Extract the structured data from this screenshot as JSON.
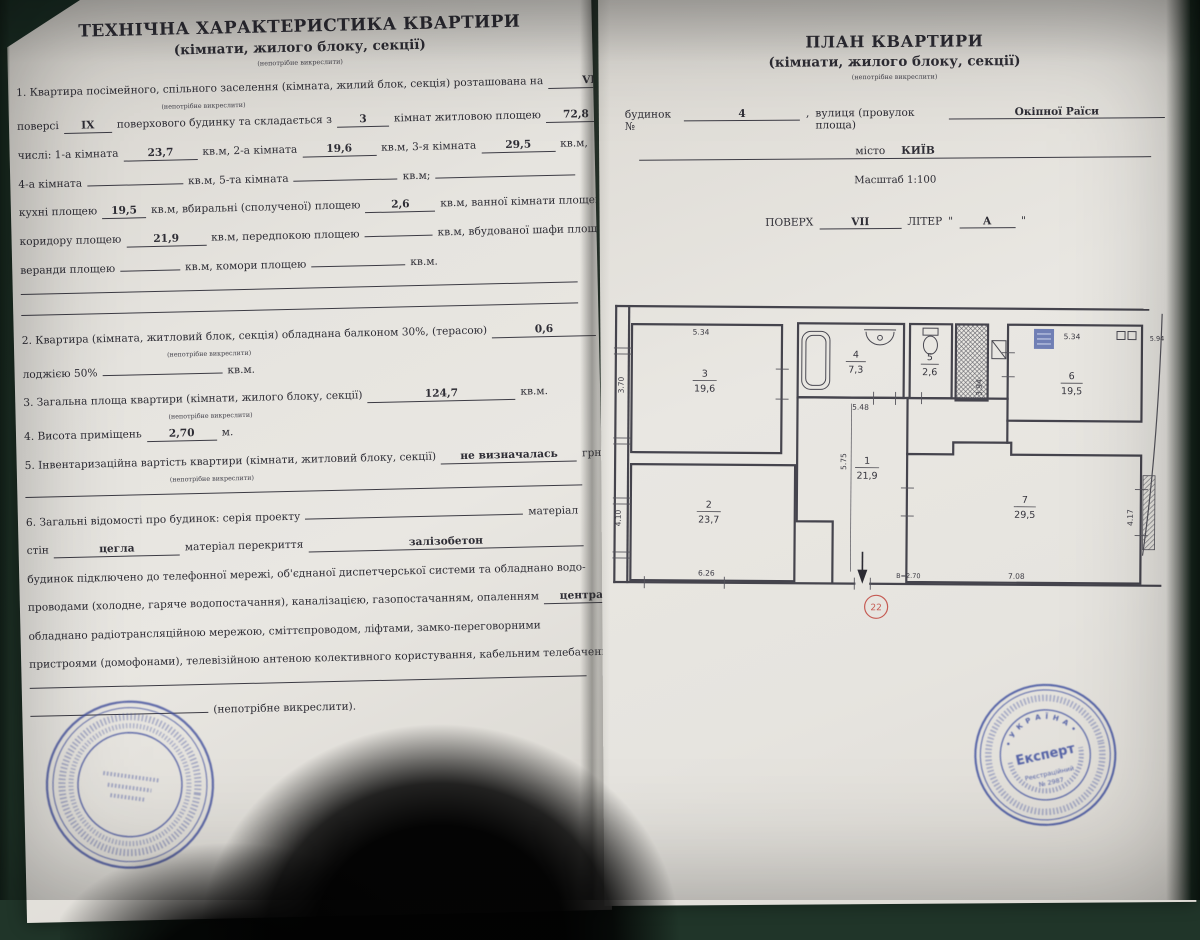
{
  "left_page": {
    "title": "ТЕХНІЧНА ХАРАКТЕРИСТИКА КВАРТИРИ",
    "subtitle": "(кімнати, жилого блоку, секції)",
    "strike_note": "(непотрібне викреслити)",
    "lines": [
      {
        "segs": [
          {
            "t": "1. Квартира посімейного, спільного заселення (кімната, жилий блок, секція) розташована на"
          },
          {
            "u": "VII",
            "w": 78,
            "fx": 1
          }
        ]
      },
      {
        "type": "note",
        "text": "(непотрібне викреслити)"
      },
      {
        "segs": [
          {
            "t": "поверсі"
          },
          {
            "u": "IX",
            "w": 40
          },
          {
            "t": "поверхового будинку та складається з"
          },
          {
            "u": "3",
            "w": 44
          },
          {
            "t": "кімнат житловою площею"
          },
          {
            "u": "72,8",
            "w": 52
          },
          {
            "t": "кв.м, у тому"
          }
        ]
      },
      {
        "segs": [
          {
            "t": "числі: 1-а кімната"
          },
          {
            "u": "23,7",
            "w": 66
          },
          {
            "t": "кв.м, 2-а кімната"
          },
          {
            "u": "19,6",
            "w": 66
          },
          {
            "t": "кв.м, 3-я кімната"
          },
          {
            "u": "29,5",
            "w": 66
          },
          {
            "t": "кв.м,"
          }
        ]
      },
      {
        "segs": [
          {
            "t": "4-а кімната"
          },
          {
            "u": "",
            "w": 88
          },
          {
            "t": "кв.м, 5-та кімната"
          },
          {
            "u": "",
            "w": 96
          },
          {
            "t": "кв.м;"
          },
          {
            "u": "",
            "w": 120,
            "flex": 1
          }
        ]
      },
      {
        "segs": [
          {
            "t": "кухні площею"
          },
          {
            "u": "19,5",
            "w": 36
          },
          {
            "t": "кв.м, вбиральні (сполученої) площею"
          },
          {
            "u": "2,6",
            "w": 62
          },
          {
            "t": "кв.м, ванної кімнати площею"
          },
          {
            "u": "7,3",
            "w": 28
          },
          {
            "t": "кв.м,"
          }
        ]
      },
      {
        "segs": [
          {
            "t": "коридору площею"
          },
          {
            "u": "21,9",
            "w": 72
          },
          {
            "t": "кв.м, передпокою площею"
          },
          {
            "u": "",
            "w": 60
          },
          {
            "t": "кв.м, вбудованої шафи площею"
          },
          {
            "u": "",
            "w": 32,
            "fx": 1
          },
          {
            "t": "кв.м,"
          }
        ]
      },
      {
        "segs": [
          {
            "t": "веранди площею"
          },
          {
            "u": "",
            "w": 52
          },
          {
            "t": "кв.м, комори площею"
          },
          {
            "u": "",
            "w": 86
          },
          {
            "t": "кв.м."
          }
        ]
      },
      {
        "type": "rule"
      },
      {
        "type": "rule"
      },
      {
        "segs": [
          {
            "t": "2. Квартира (кімната, житловий блок, секція) обладнана балконом 30%, (терасою)"
          },
          {
            "u": "0,6",
            "w": 96
          },
          {
            "t": "кв.м."
          }
        ]
      },
      {
        "type": "note",
        "text": "(непотрібне викреслити)"
      },
      {
        "segs": [
          {
            "t": "лоджією 50%"
          },
          {
            "u": "",
            "w": 112
          },
          {
            "t": "кв.м."
          }
        ]
      },
      {
        "segs": [
          {
            "t": "3. Загальна площа квартири  (кімнати, жилого блоку, секції)"
          },
          {
            "u": "124,7",
            "w": 140
          },
          {
            "t": "кв.м."
          }
        ]
      },
      {
        "type": "note",
        "text": "(непотрібне викреслити)"
      },
      {
        "segs": [
          {
            "t": "4. Висота приміщень"
          },
          {
            "u": "2,70",
            "w": 62
          },
          {
            "t": "м."
          }
        ]
      },
      {
        "segs": [
          {
            "t": "5. Інвентаризаційна вартість квартири (кімнати, житловий блоку, секції)"
          },
          {
            "u": "не визначалась",
            "w": 128
          },
          {
            "t": "грн."
          }
        ]
      },
      {
        "type": "note",
        "text": "(непотрібне викреслити)"
      },
      {
        "type": "rule"
      },
      {
        "segs": [
          {
            "t": "6. Загальні відомості про будинок: серія проекту"
          },
          {
            "u": "",
            "w": 210
          },
          {
            "t": "матеріал"
          }
        ]
      },
      {
        "segs": [
          {
            "t": "стін"
          },
          {
            "u": "цегла",
            "w": 118
          },
          {
            "t": "матеріал перекриття"
          },
          {
            "u": "залізобетон",
            "w": 200,
            "flex": 1
          }
        ]
      },
      {
        "segs": [
          {
            "t": "будинок підключено до телефонної мережі, об'єднаної диспетчерської системи та обладнано водо-"
          }
        ]
      },
      {
        "segs": [
          {
            "t": "проводами (холодне, гаряче водопостачання), каналізацією, газопостачанням, опаленням"
          },
          {
            "u": "центральне",
            "w": 96,
            "flex": 1
          }
        ]
      },
      {
        "segs": [
          {
            "t": "обладнано радіотрансляційною мережою, сміттєпроводом, ліфтами, замко-переговорними"
          }
        ]
      },
      {
        "segs": [
          {
            "t": "пристроями (домофонами), телевізійною антеною колективного користування, кабельним телебаченням"
          }
        ]
      },
      {
        "type": "rule"
      },
      {
        "segs": [
          {
            "u": "",
            "w": 170
          },
          {
            "t": "(непотрібне викреслити)."
          }
        ]
      }
    ]
  },
  "right_page": {
    "title": "ПЛАН КВАРТИРИ",
    "subtitle": "(кімнати, жилого блоку, секції)",
    "strike_note": "(непотрібне викреслити)",
    "building_label": "будинок №",
    "building_value": "4",
    "comma": ",",
    "street_label": "вулиця (провулок площа)",
    "street_value": "Окіпної Раїси",
    "city_label": "місто",
    "city_value": "КИЇВ",
    "scale": "Масштаб 1:100",
    "floor_label": "ПОВЕРХ",
    "floor_value": "VII",
    "liter_label": "ЛІТЕР",
    "quote": "\"",
    "liter_value": "А"
  },
  "plan": {
    "rooms": {
      "hall": {
        "num": "1",
        "area": "21,9"
      },
      "room2": {
        "num": "2",
        "area": "23,7"
      },
      "room3": {
        "num": "3",
        "area": "19,6"
      },
      "bath": {
        "num": "4",
        "area": "7,3"
      },
      "wc": {
        "num": "5",
        "area": "2,6"
      },
      "kitchen": {
        "num": "6",
        "area": "19,5"
      },
      "room7": {
        "num": "7",
        "area": "29,5"
      }
    },
    "dims": {
      "room3_top": "5.34",
      "room3_left": "3.70",
      "bath_bottom": "5.48",
      "shaft_side": "3.94",
      "kitchen_top": "5.34",
      "kitchen_right": "5.94",
      "hall_v": "5.75",
      "room2_bottom": "6.26",
      "room2_left": "4.10",
      "room7_bottom": "7.08",
      "room7_right": "4.17",
      "height_note": "В=2.70"
    },
    "door_number": "22"
  },
  "stamps": {
    "expert": {
      "ring_top": "•  У К Р А Ї Н А  •",
      "center": "Експерт",
      "line1": "Реєстраційний",
      "line2": "№ 2987"
    }
  },
  "colors": {
    "stamp_blue": "#4252a0",
    "red": "#c0443c",
    "ink": "#3c3b44"
  }
}
